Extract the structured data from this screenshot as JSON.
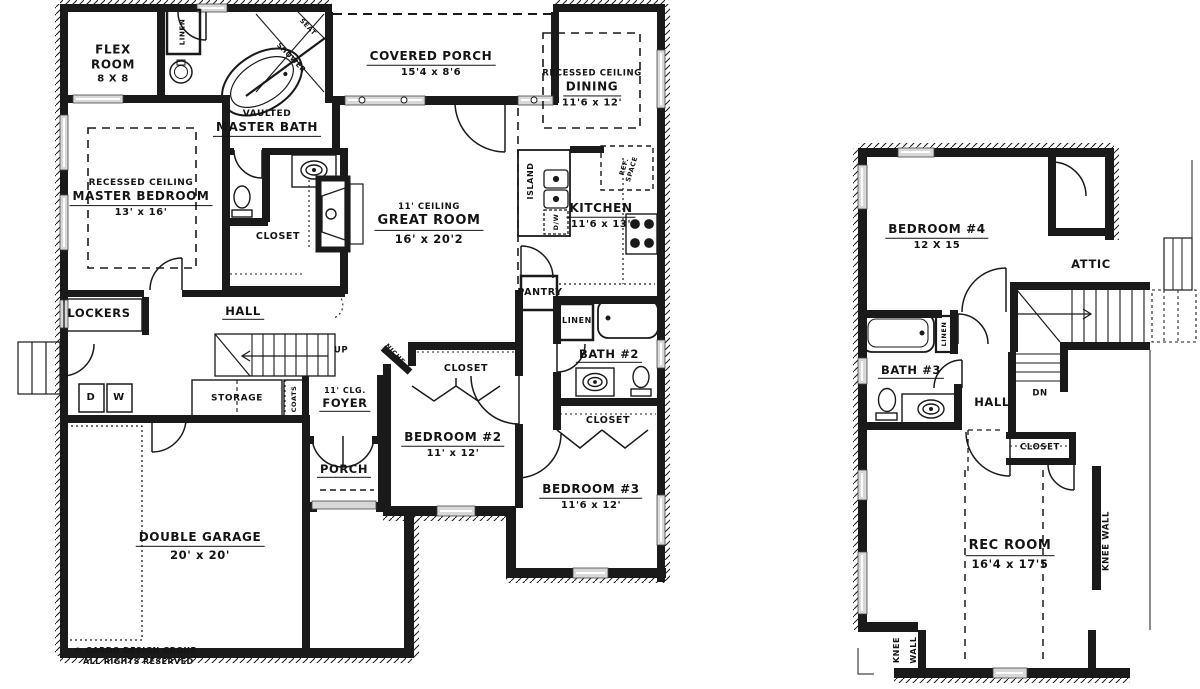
{
  "colors": {
    "ink": "#1a1a1a",
    "paper": "#ffffff",
    "window": "#d8d8d8"
  },
  "main_floor": {
    "flex": {
      "name1": "FLEX",
      "name2": "ROOM",
      "dims": "8 X 8"
    },
    "linen_hall": {
      "name": "LINEN"
    },
    "shower": {
      "name": "SHOWER"
    },
    "seat": {
      "name": "SEAT"
    },
    "master_bath": {
      "sub": "VAULTED",
      "name": "MASTER BATH"
    },
    "covered_porch": {
      "name": "COVERED PORCH",
      "dims": "15'4 x 8'6"
    },
    "dining": {
      "sub": "RECESSED CEILING",
      "name": "DINING",
      "dims": "11'6 x 12'"
    },
    "master_bedroom": {
      "sub": "RECESSED CEILING",
      "name": "MASTER BEDROOM",
      "dims": "13' x 16'"
    },
    "master_closet": {
      "name": "CLOSET"
    },
    "great_room": {
      "sub": "11' CEILING",
      "name": "GREAT ROOM",
      "dims": "16' x 20'2"
    },
    "island": {
      "name": "ISLAND"
    },
    "dishwasher": {
      "name": "D/W"
    },
    "ref_space": {
      "line1": "REF.",
      "line2": "SPACE"
    },
    "kitchen": {
      "name": "KITCHEN",
      "dims": "11'6 x 13'"
    },
    "pantry": {
      "name": "PANTRY"
    },
    "lockers": {
      "name": "LOCKERS"
    },
    "hall": {
      "name": "HALL"
    },
    "up": {
      "label": "UP"
    },
    "dryer": {
      "label": "D"
    },
    "washer": {
      "label": "W"
    },
    "storage": {
      "name": "STORAGE"
    },
    "coats": {
      "name": "COATS"
    },
    "foyer": {
      "sub": "11' CLG.",
      "name": "FOYER"
    },
    "niche": {
      "name": "NICHE"
    },
    "porch": {
      "name": "PORCH"
    },
    "bedroom2_closet": {
      "name": "CLOSET"
    },
    "bedroom2": {
      "name": "BEDROOM #2",
      "dims": "11' x 12'"
    },
    "linen_bath2": {
      "name": "LINEN"
    },
    "bath2": {
      "name": "BATH #2"
    },
    "bedroom3_closet": {
      "name": "CLOSET"
    },
    "bedroom3": {
      "name": "BEDROOM #3",
      "dims": "11'6 x 12'"
    },
    "garage": {
      "name": "DOUBLE GARAGE",
      "dims": "20' x 20'"
    },
    "copyright": {
      "line1": "© GARDO DESIGN GROUP",
      "line2": "ALL RIGHTS RESERVED"
    }
  },
  "upper_floor": {
    "bedroom4": {
      "name": "BEDROOM #4",
      "dims": "12 X 15"
    },
    "attic": {
      "name": "ATTIC"
    },
    "linen": {
      "name": "LINEN"
    },
    "bath3": {
      "name": "BATH #3"
    },
    "hall": {
      "name": "HALL"
    },
    "dn": {
      "label": "DN"
    },
    "closet": {
      "name": "CLOSET"
    },
    "rec_room": {
      "name": "REC ROOM",
      "dims": "16'4 x 17'5"
    },
    "knee_wall_right": {
      "name": "KNEE WALL"
    },
    "knee_wall_bottom": {
      "word1": "KNEE",
      "word2": "WALL"
    }
  }
}
